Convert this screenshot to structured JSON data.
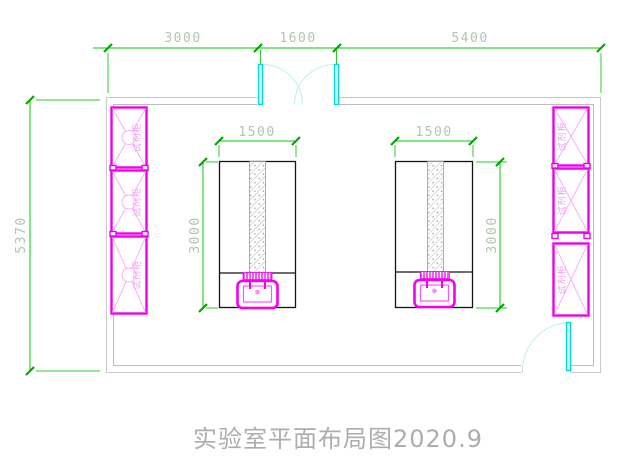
{
  "drawing": {
    "title": "实验室平面布局图2020.9",
    "dimensions": {
      "top": [
        {
          "value": "3000"
        },
        {
          "value": "1600"
        },
        {
          "value": "5400"
        }
      ],
      "left_height": "5370",
      "bench_left": {
        "width": "1500",
        "depth": "3000"
      },
      "bench_right": {
        "width": "1500",
        "depth": "3000"
      }
    },
    "cabinets": {
      "left": [
        {
          "label": "试剂柜"
        },
        {
          "label": "试剂柜"
        },
        {
          "label": "试剂柜"
        }
      ],
      "right": [
        {
          "label": "试剂柜"
        },
        {
          "label": "试剂柜"
        },
        {
          "label": "试剂柜"
        }
      ]
    },
    "colors": {
      "dimension_line": "#00cc00",
      "dimension_text": "#aec7ae",
      "wall": "#c9c9c9",
      "cabinet": "#ee00ee",
      "cabinet_detail": "#ffaaff",
      "door": "#00dcdc",
      "door_arc": "#c0eeee",
      "bench_outline": "#141414",
      "title_text": "#adadad"
    }
  }
}
